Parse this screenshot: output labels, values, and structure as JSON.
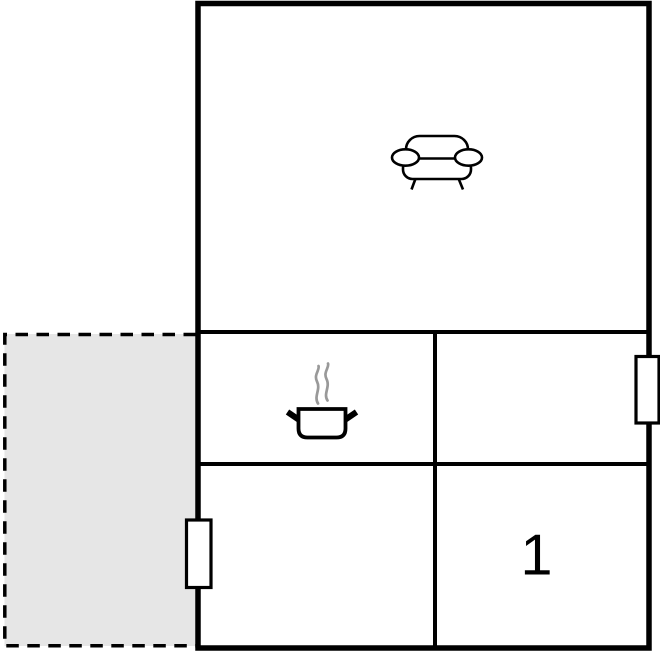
{
  "plan": {
    "type": "floor-plan",
    "colors": {
      "wall": "#000000",
      "background": "#ffffff",
      "terrace_fill": "#e6e6e6",
      "steam": "#999999"
    },
    "rooms": [
      {
        "name": "living-room",
        "icon": "sofa-icon",
        "label": ""
      },
      {
        "name": "kitchen",
        "icon": "cooking-pot-icon",
        "label": ""
      },
      {
        "name": "room-middle-right",
        "icon": "",
        "label": ""
      },
      {
        "name": "room-bottom-left",
        "icon": "",
        "label": ""
      },
      {
        "name": "bedroom",
        "icon": "",
        "label": "1"
      },
      {
        "name": "terrace",
        "icon": "",
        "label": ""
      }
    ],
    "windows": [
      {
        "name": "window-left-wall"
      },
      {
        "name": "window-right-wall"
      }
    ]
  }
}
